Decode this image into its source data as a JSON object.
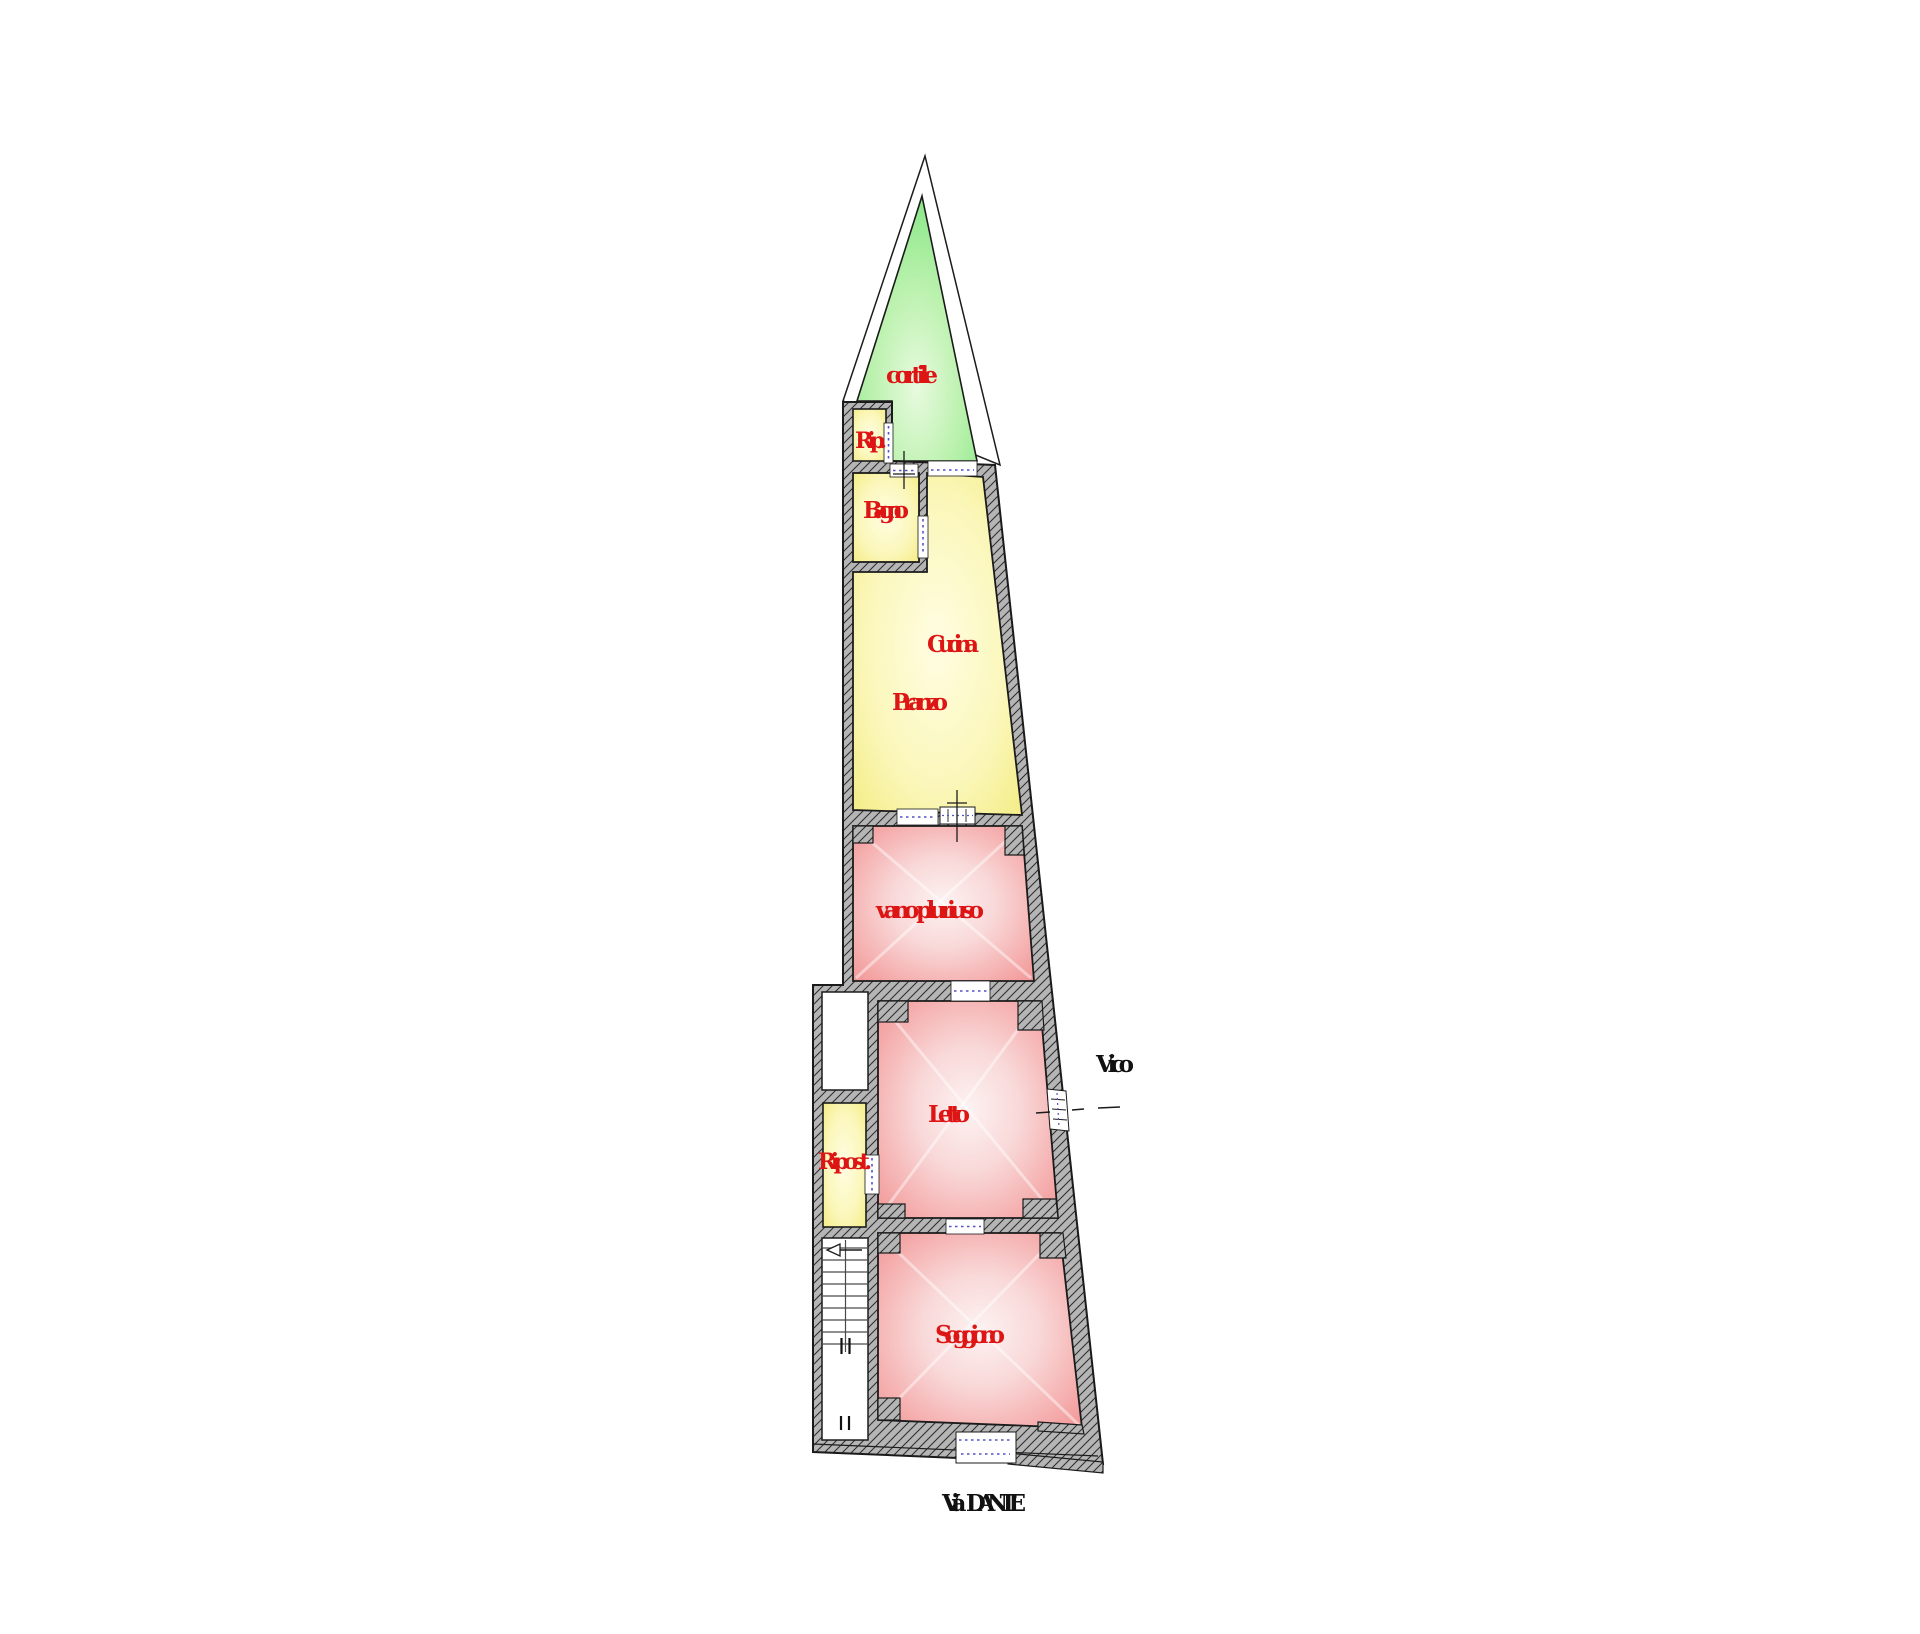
{
  "plan": {
    "rooms": {
      "cortile": {
        "label": "cortile"
      },
      "rip": {
        "label": "Rip."
      },
      "bagno": {
        "label": "Bagno"
      },
      "cucina": {
        "label": "Cucina"
      },
      "pranzo": {
        "label": "Pranzo"
      },
      "vano_pluriuso": {
        "label": "vano pluriuso"
      },
      "letto": {
        "label": "Letto"
      },
      "ripost": {
        "label": "Ripost."
      },
      "soggiono": {
        "label": "Soggiono"
      }
    },
    "streets": {
      "vico": {
        "label": "Vico"
      },
      "via_dante": {
        "label": "Via DANTE"
      }
    },
    "colors": {
      "wall_fill": "#b5b5b5",
      "wall_hatch": "#2f2f2f",
      "outline": "#1b1b1b",
      "courtyard_green": "#7fe57f",
      "room_yellow": "#f3eb7e",
      "room_pink": "#f19494",
      "label_red": "#dd1515",
      "street_label_black": "#111111",
      "door_dash_blue": "#5252c8"
    }
  }
}
